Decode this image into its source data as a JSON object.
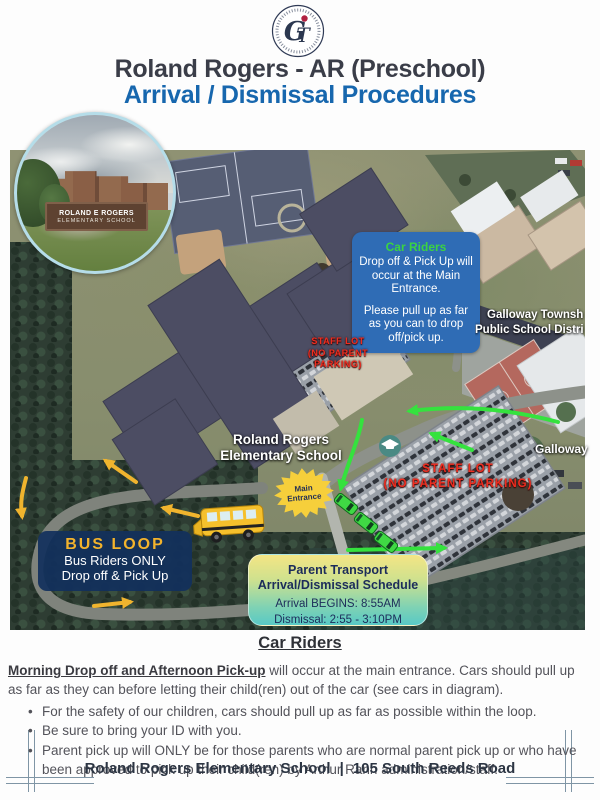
{
  "logo": {
    "g": "G",
    "t": "T"
  },
  "header": {
    "title": "Roland Rogers - AR (Preschool)",
    "subtitle": "Arrival / Dismissal Procedures"
  },
  "map": {
    "inset": {
      "sign_line1": "ROLAND E ROGERS",
      "sign_line2": "ELEMENTARY SCHOOL"
    },
    "car_riders_box": {
      "title": "Car Riders",
      "p1": "Drop off  & Pick Up will occur at the Main Entrance.",
      "p2": "Please pull up as far as you can to drop off/pick up."
    },
    "township_label": {
      "line1": "Galloway Townsh",
      "line2": "Public School Distri"
    },
    "galloway_label": "Galloway",
    "school_label": {
      "line1": "Roland Rogers",
      "line2": "Elementary School"
    },
    "staff_lot_small": {
      "line1": "STAFF LOT",
      "line2": "(NO PARENT",
      "line3": "PARKING)"
    },
    "staff_lot_large": {
      "line1": "STAFF LOT",
      "line2": "(NO PARENT  PARKING)"
    },
    "main_entrance": {
      "line1": "Main",
      "line2": "Entrance"
    },
    "bus_loop_box": {
      "title": "BUS LOOP",
      "line1": "Bus Riders ONLY",
      "line2": "Drop off & Pick Up"
    },
    "schedule_box": {
      "title1": "Parent Transport",
      "title2": "Arrival/Dismissal Schedule",
      "arrival": "Arrival BEGINS: 8:55AM",
      "dismissal": "Dismissal: 2:55 - 3:10PM"
    }
  },
  "section": {
    "heading": "Car Riders",
    "intro_lead": "Morning Drop off and Afternoon Pick-up",
    "intro_rest": " will occur at the main entrance. Cars should pull up as far as they can before letting their child(ren) out of the car (see cars in diagram).",
    "bullets": [
      "For the safety of our children, cars should pull up as far as possible within the loop.",
      "Be sure to bring your ID with you.",
      "Parent pick up will ONLY be for those parents who are normal parent pick up or who have been approved to pick up their child(ren) by Arthur Rann administration/staff."
    ]
  },
  "footer": {
    "school": "Roland Rogers Elementary School",
    "separator": "|",
    "address": "105 South Reeds Road"
  },
  "colors": {
    "title_dark": "#3a3d48",
    "subtitle_blue": "#1767ae",
    "car_riders_green": "#3bd342",
    "info_box_blue": "#2f6cb5",
    "staff_lot_red": "#ef2d20",
    "bus_loop_gold": "#f3b32c",
    "bus_loop_navy": "#12305c",
    "schedule_yellow": "#f4e584",
    "schedule_teal": "#58c9c6",
    "main_entrance_yellow": "#f6cf3b",
    "route_green": "#35e23e",
    "route_yellow": "#f0b42e"
  }
}
